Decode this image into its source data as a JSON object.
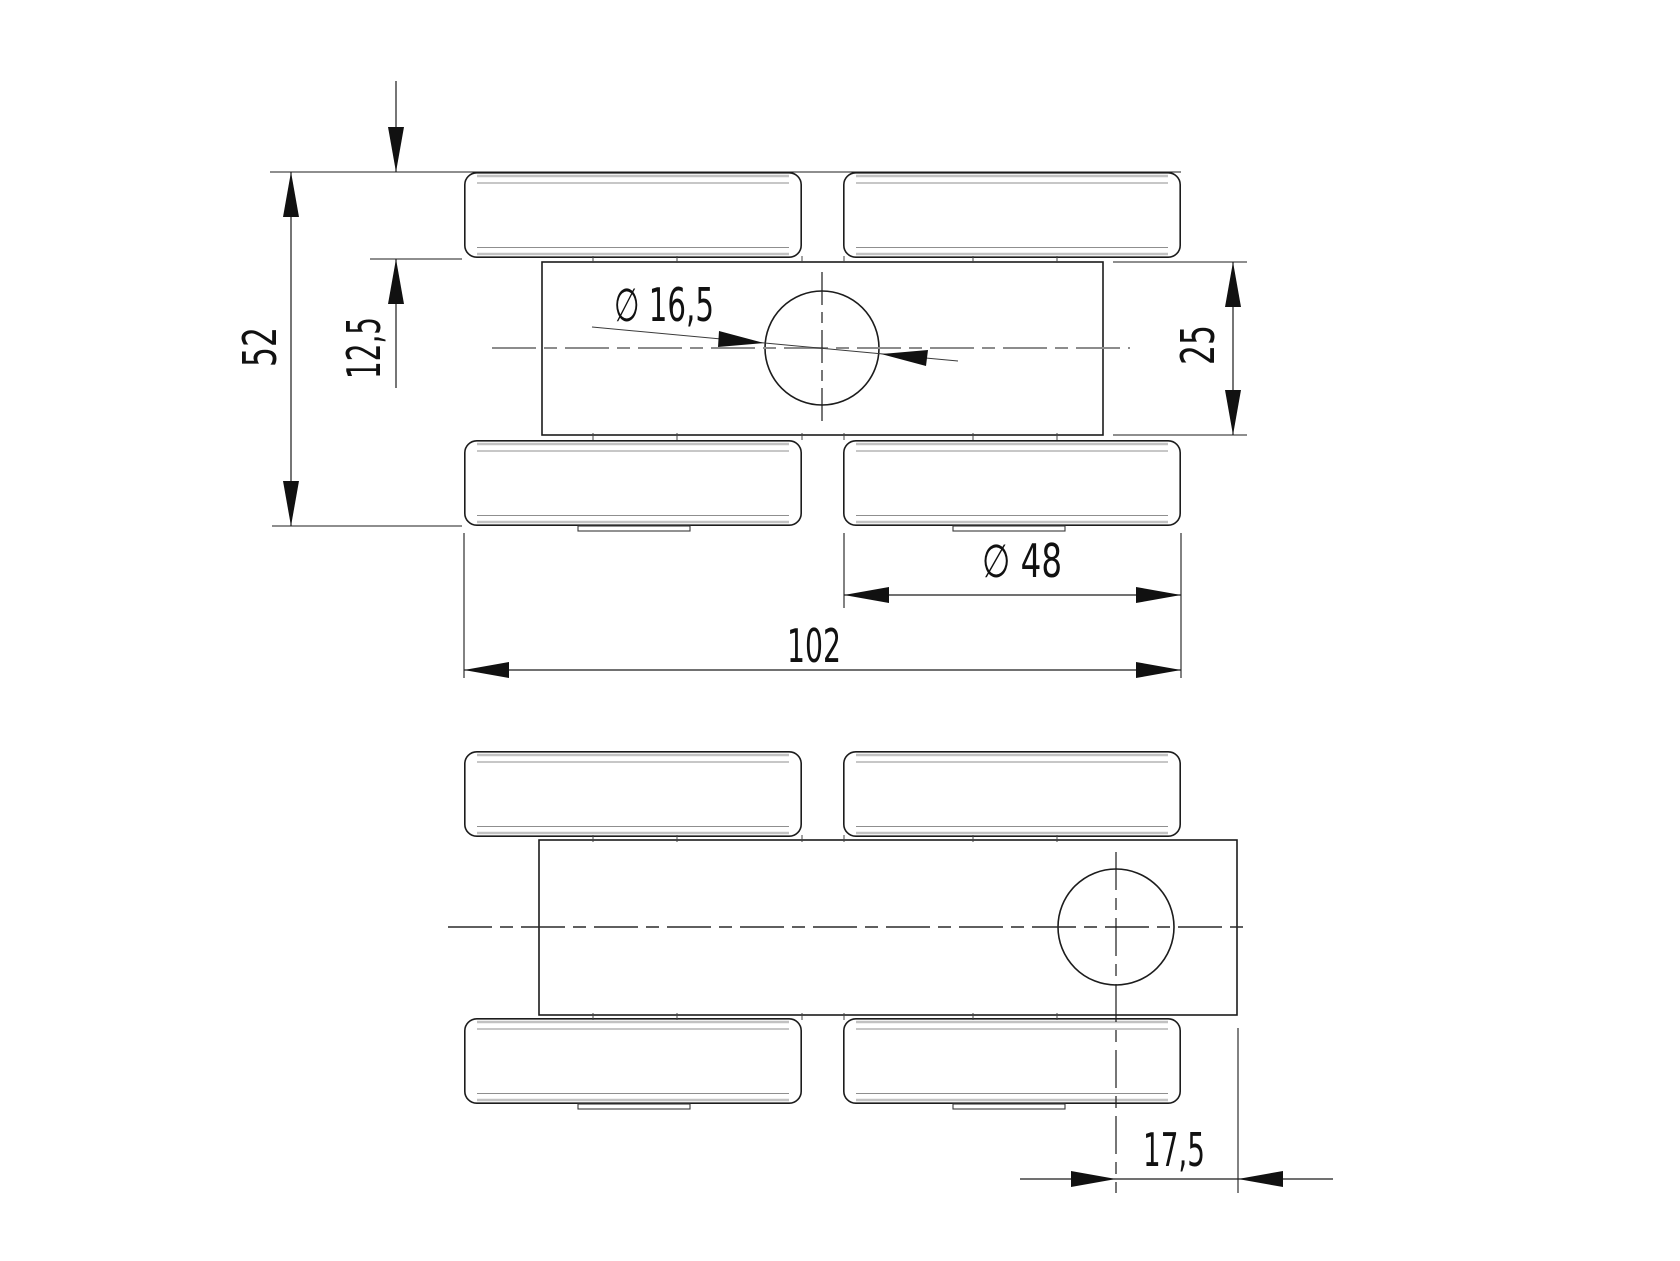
{
  "drawing": {
    "kind": "technical-drawing",
    "units_decimal_separator": ",",
    "colors": {
      "background": "#ffffff",
      "main_line": "#1c1c1c",
      "centerline_gray": "#8c8c8c",
      "centerline_dark": "#2a2a2a",
      "inner_line": "#8f8f8f",
      "edge_accent": "#c2c2c2",
      "text": "#111111"
    },
    "views": {
      "front_view": {
        "name": "front-view",
        "dimensions": {
          "overall_height": "52",
          "roller_offset_height": "12,5",
          "plate_height": "25",
          "hole_diameter": "∅ 16,5",
          "roller_diameter": "∅ 48",
          "overall_length": "102"
        }
      },
      "plan_view": {
        "name": "plan-view",
        "dimensions": {
          "hole_end_offset": "17,5"
        }
      }
    }
  }
}
